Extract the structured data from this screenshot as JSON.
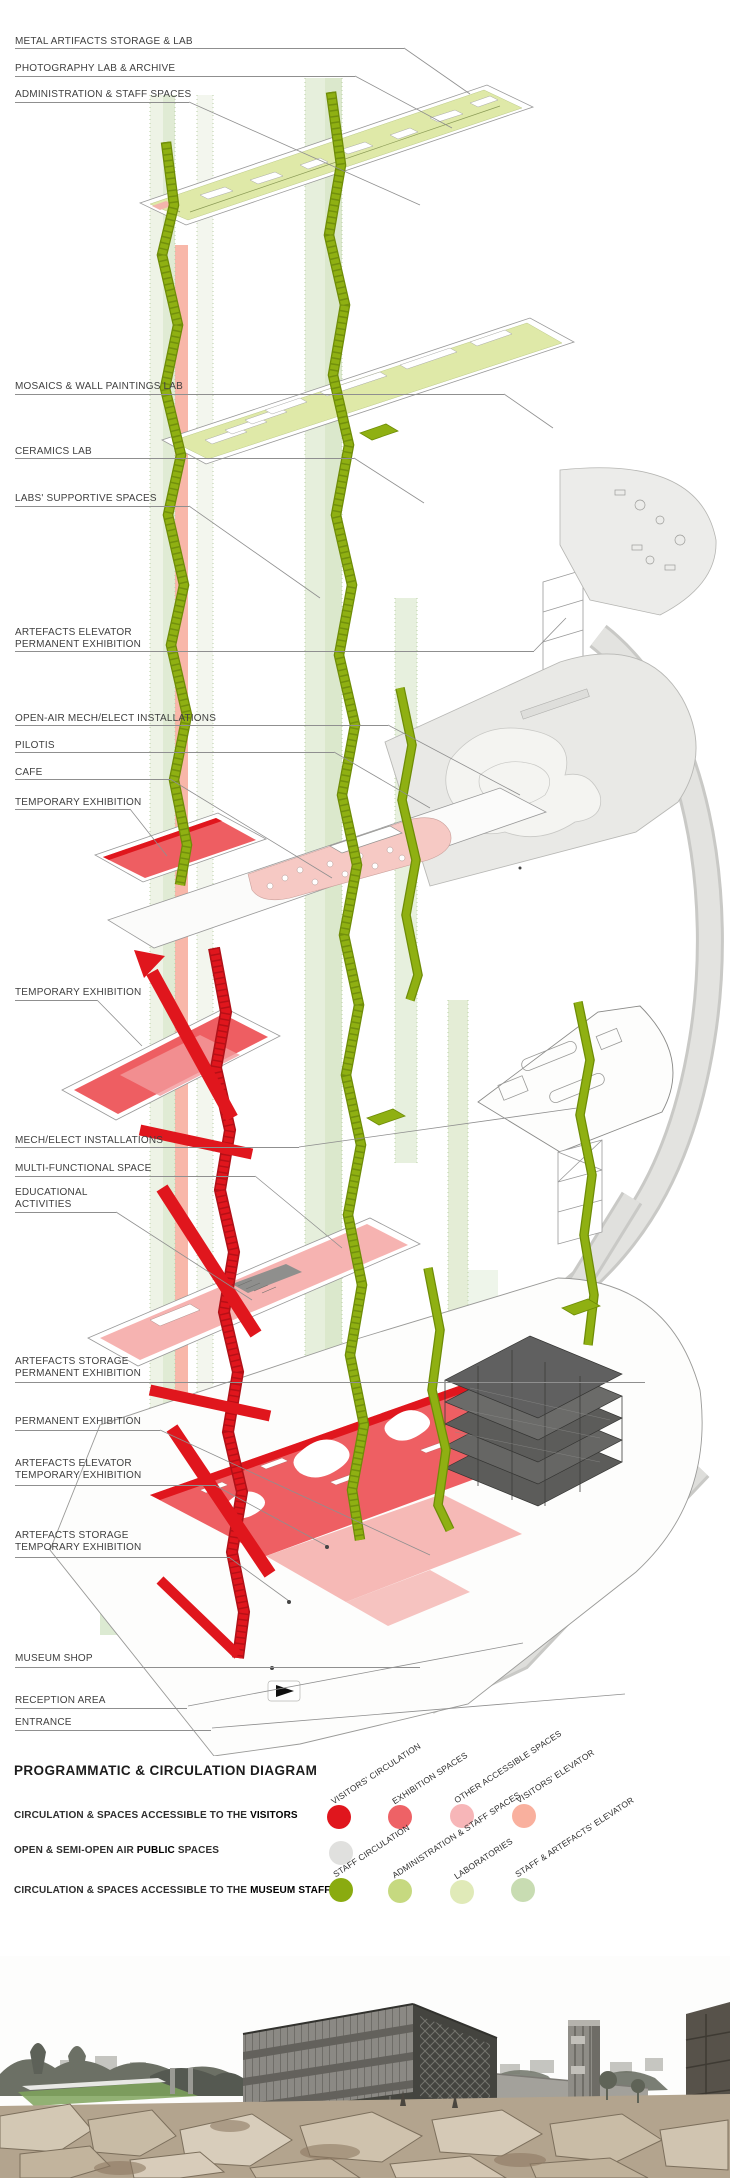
{
  "annotations": [
    {
      "text": "METAL ARTIFACTS STORAGE & LAB"
    },
    {
      "text": "PHOTOGRAPHY LAB & ARCHIVE"
    },
    {
      "text": "ADMINISTRATION & STAFF SPACES"
    },
    {
      "text": "MOSAICS & WALL PAINTINGS LAB"
    },
    {
      "text": "CERAMICS LAB"
    },
    {
      "text": "LABS' SUPPORTIVE SPACES"
    },
    {
      "text": "ARTEFACTS ELEVATOR\nPERMANENT EXHIBITION"
    },
    {
      "text": "OPEN-AIR MECH/ELECT INSTALLATIONS"
    },
    {
      "text": "PILOTIS"
    },
    {
      "text": "CAFE"
    },
    {
      "text": "TEMPORARY EXHIBITION"
    },
    {
      "text": "TEMPORARY EXHIBITION"
    },
    {
      "text": "MECH/ELECT INSTALLATIONS"
    },
    {
      "text": "MULTI-FUNCTIONAL SPACE"
    },
    {
      "text": "EDUCATIONAL\nACTIVITIES"
    },
    {
      "text": "ARTEFACTS STORAGE\nPERMANENT EXHIBITION"
    },
    {
      "text": "PERMANENT EXHIBITION"
    },
    {
      "text": "ARTEFACTS ELEVATOR\nTEMPORARY EXHIBITION"
    },
    {
      "text": "ARTEFACTS STORAGE\nTEMPORARY EXHIBITION"
    },
    {
      "text": "MUSEUM SHOP"
    },
    {
      "text": "RECEPTION AREA"
    },
    {
      "text": "ENTRANCE"
    }
  ],
  "legend": {
    "title": "PROGRAMMATIC & CIRCULATION DIAGRAM",
    "rows": [
      {
        "pre": "CIRCULATION & SPACES ACCESSIBLE TO THE ",
        "strong": "VISITORS",
        "post": ""
      },
      {
        "pre": "OPEN & SEMI-OPEN AIR ",
        "strong": "PUBLIC",
        "post": " SPACES"
      },
      {
        "pre": "CIRCULATION & SPACES ACCESSIBLE TO THE ",
        "strong": "MUSEUM STAFF",
        "post": ""
      }
    ],
    "swatches": [
      {
        "label": "VISITORS' CIRCULATION",
        "color": "#e0161d"
      },
      {
        "label": "EXHIBITION SPACES",
        "color": "#ee6266"
      },
      {
        "label": "OTHER ACCESSIBLE SPACES",
        "color": "#f7b6b8"
      },
      {
        "label": "VISITORS' ELEVATOR",
        "color": "#f9b09e"
      },
      {
        "label": "",
        "color": "#d8d8d6"
      },
      {
        "label": "STAFF CIRCULATION",
        "color": "#8aab10"
      },
      {
        "label": "ADMINISTRATION & STAFF SPACES",
        "color": "#c6d980"
      },
      {
        "label": "LABORATORIES",
        "color": "#e0eab8"
      },
      {
        "label": "STAFF & ARTEFACTS' ELEVATOR",
        "color": "#c8dcb2"
      }
    ]
  },
  "colors": {
    "visitors_circulation": "#e0161d",
    "exhibition_spaces": "#ee6266",
    "other_accessible_spaces": "#f7b6b8",
    "visitors_elevator": "#f9b09e",
    "open_public": "#d8d8d6",
    "staff_circulation": "#8aab10",
    "administration_staff": "#c6d980",
    "laboratories": "#e0eab8",
    "staff_artefacts_elevator": "#c8dcb2"
  }
}
